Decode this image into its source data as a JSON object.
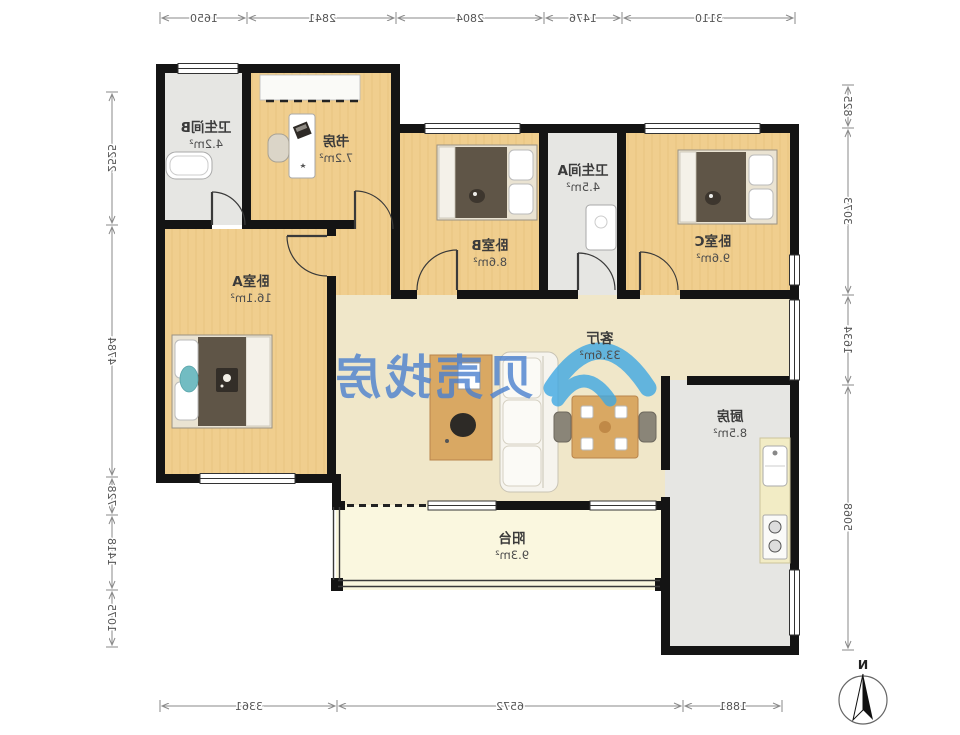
{
  "floorplan": {
    "rooms": [
      {
        "name": "卫生间B",
        "area": "4.2m²"
      },
      {
        "name": "书房",
        "area": "7.2m²"
      },
      {
        "name": "卧室B",
        "area": "8.6m²"
      },
      {
        "name": "卫生间A",
        "area": "4.5m²"
      },
      {
        "name": "卧室C",
        "area": "9.6m²"
      },
      {
        "name": "卧室A",
        "area": "16.1m²"
      },
      {
        "name": "客厅",
        "area": "33.6m²"
      },
      {
        "name": "厨房",
        "area": "8.5m²"
      },
      {
        "name": "阳台",
        "area": "9.3m²"
      }
    ],
    "dimensions_mm": {
      "top": [
        "1650",
        "2841",
        "2804",
        "1476",
        "3110"
      ],
      "left": [
        "2525",
        "4784",
        "728",
        "1418",
        "1075"
      ],
      "right": [
        "825",
        "3073",
        "1634",
        "5068"
      ],
      "bottom": [
        "3361",
        "6572",
        "1881"
      ]
    },
    "compass_label": "N",
    "watermark_text": "贝壳找房",
    "colors": {
      "wood_floor": "#F0CE8E",
      "living_floor": "#F0E7C9",
      "balcony_floor": "#FAF7DF",
      "wet_room_floor": "#E6E6E3",
      "wall": "#141414",
      "watermark_text_blue": "#4A80CF",
      "watermark_logo_blue": "#3FA8E3",
      "dimension_text": "#555555"
    }
  }
}
